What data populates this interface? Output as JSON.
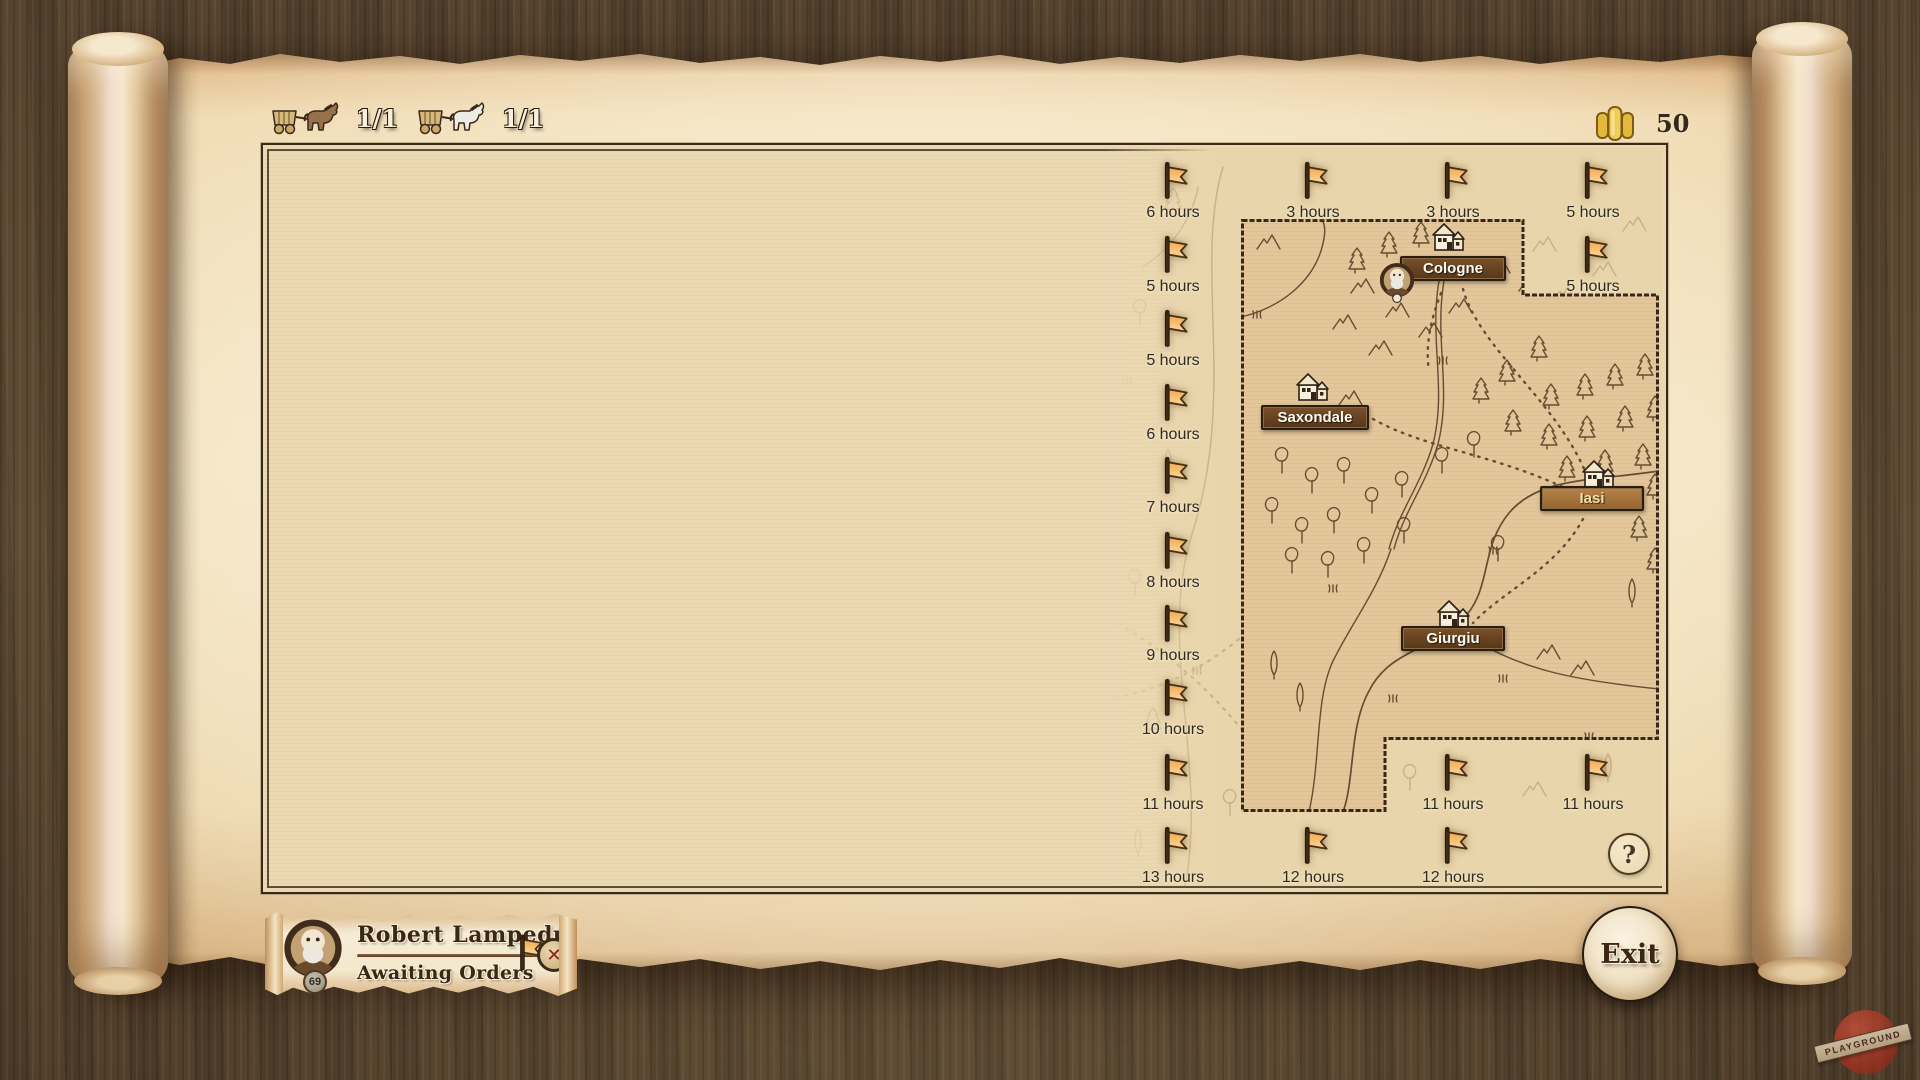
{
  "top_bar": {
    "caravan_counts": [
      "1/1",
      "1/1"
    ],
    "gold_amount": "50"
  },
  "flags": [
    {
      "label": "6 hours"
    },
    {
      "label": "5 hours"
    },
    {
      "label": "5 hours"
    },
    {
      "label": "6 hours"
    },
    {
      "label": "7 hours"
    },
    {
      "label": "8 hours"
    },
    {
      "label": "9 hours"
    },
    {
      "label": "10 hours"
    },
    {
      "label": "11 hours"
    },
    {
      "label": "13 hours"
    },
    {
      "label": "3 hours"
    },
    {
      "label": "12 hours"
    },
    {
      "label": "3 hours"
    },
    {
      "label": "11 hours"
    },
    {
      "label": "12 hours"
    },
    {
      "label": "5 hours"
    },
    {
      "label": "5 hours"
    },
    {
      "label": "11 hours"
    }
  ],
  "towns": [
    {
      "name": "Cologne"
    },
    {
      "name": "Saxondale"
    },
    {
      "name": "Iasi"
    },
    {
      "name": "Giurgiu"
    }
  ],
  "help_label": "?",
  "character_card": {
    "name": "Robert Lampedusa",
    "status": "Awaiting Orders",
    "level": "69",
    "close_icon": "✕"
  },
  "exit_label": "Exit",
  "watermark": "PLAYGROUND",
  "colors": {
    "flag_orange": "#f2a94e",
    "banner_dark": "#5d3a1e",
    "banner_light": "#a8743f",
    "gold": "#e8c34a",
    "logo_red": "#a93425",
    "parchment": "#ecd9b4",
    "wood": "#5b4831"
  }
}
